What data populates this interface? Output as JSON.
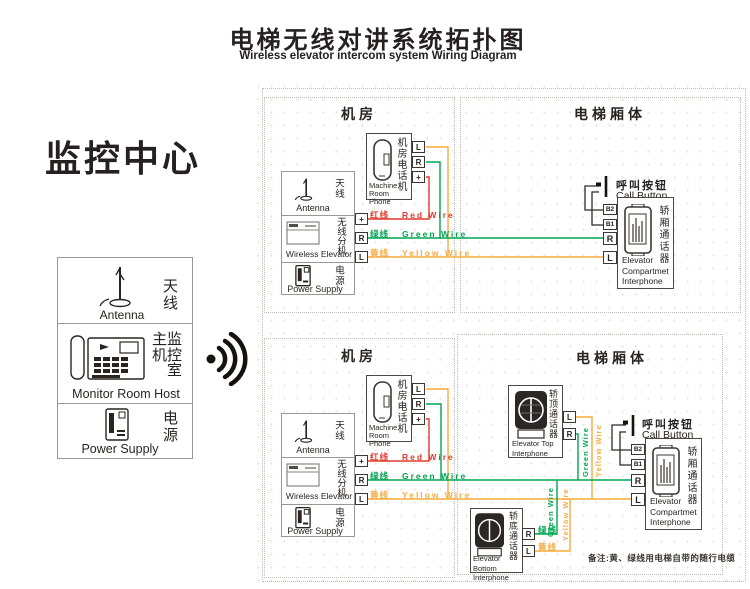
{
  "header": {
    "title_cn": "电梯无线对讲系统拓扑图",
    "title_en": "Wireless elevator intercom system Wiring Diagram"
  },
  "monitoring_center": "监控中心",
  "control_panel": {
    "antenna_cn": "天线",
    "antenna_en": "Antenna",
    "host_cn_row1": "主监",
    "host_cn_row2": "机控",
    "host_cn_row3": "室",
    "host_en": "Monitor Room Host",
    "power_cn": "电源",
    "power_en": "Power Supply"
  },
  "sections": {
    "machine_room": "机房",
    "elevator_car": "电梯厢体"
  },
  "devices": {
    "machine_phone_cn": "机房电话机",
    "machine_phone_en_line1": "Machine",
    "machine_phone_en_line2": "Room Phone",
    "station_antenna_cn": "天线",
    "station_antenna_en": "Antenna",
    "wireless_cn": "无线分机",
    "wireless_en": "Wireless Elevator",
    "power_cn": "电源",
    "power_en": "Power Supply",
    "call_button_cn": "呼叫按钮",
    "call_button_en": "Call Button",
    "compartment_cn": "轿厢通话器",
    "compartment_en_line1": "Elevator",
    "compartment_en_line2": "Compartmet",
    "compartment_en_line3": "Interphone",
    "top_interphone_cn": "轿顶通话器",
    "top_interphone_en_line1": "Elevator Top",
    "top_interphone_en_line2": "Interphone",
    "bottom_interphone_cn": "轿底通话器",
    "bottom_interphone_en_line1": "Elevator Bottom",
    "bottom_interphone_en_line2": "Interphone"
  },
  "terminals": {
    "l": "L",
    "r": "R",
    "plus": "+",
    "b1": "B1",
    "b2": "B2"
  },
  "wires": {
    "red": {
      "cn": "红线",
      "en": "Red Wire",
      "color": "#e03a2c"
    },
    "green": {
      "cn": "绿线",
      "en": "Green Wire",
      "color": "#00a551"
    },
    "yellow": {
      "cn": "黄线",
      "en": "Yellow Wire",
      "color": "#f7ab3e"
    }
  },
  "note": "备注:黄、绿线用电梯自带的随行电缆"
}
